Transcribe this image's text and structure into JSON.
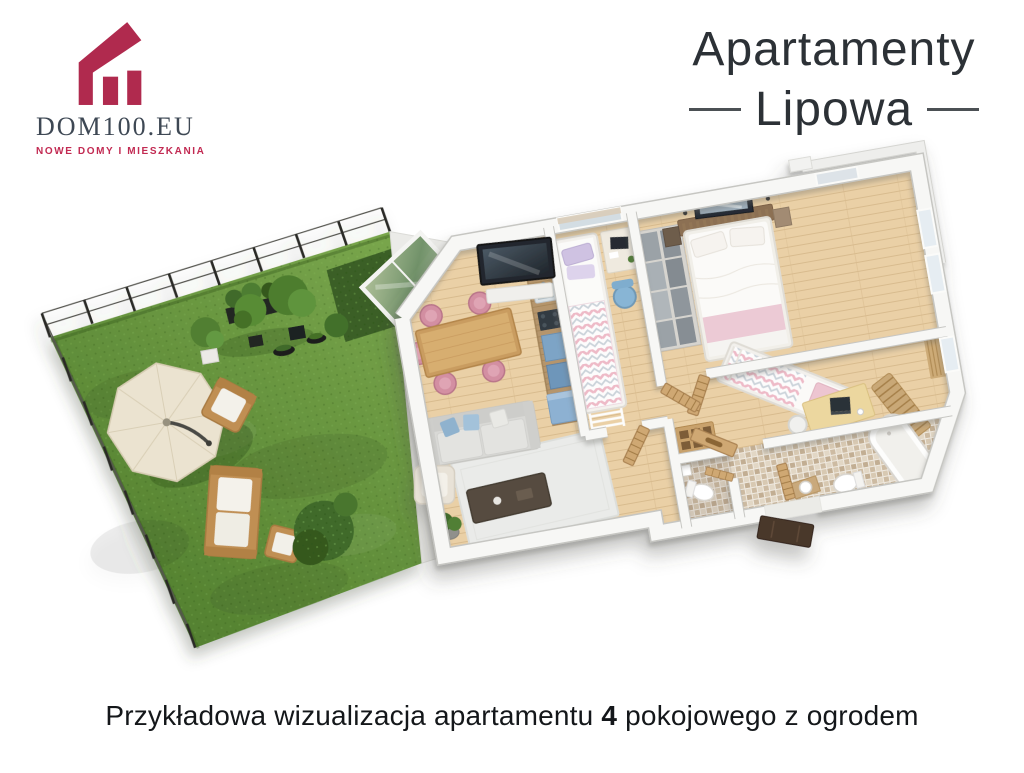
{
  "branding": {
    "name": "DOM100.EU",
    "tagline": "NOWE DOMY I MIESZKANIA"
  },
  "header": {
    "title_line1": "Apartamenty",
    "title_line2": "Lipowa"
  },
  "caption": {
    "prefix": "Przykładowa wizualizacja apartamentu ",
    "highlight": "4",
    "suffix": " pokojowego z ogrodem"
  },
  "palette": {
    "brand_crimson": "#b02a4e",
    "logo_text": "#3e4854",
    "title_text": "#2c3136",
    "caption_text": "#14171a",
    "grass_green": "#5e8c36",
    "wood_floor": "#ead0a6",
    "wall_white": "#f7f7f5",
    "kitchen_blue": "#7da4c6",
    "chair_pink": "#d38fa2",
    "door_tan": "#cfa873",
    "entrance_brown": "#4a3729",
    "tile_beige": "#cdbba2"
  },
  "illustration": {
    "type": "3d-floorplan-render",
    "areas": [
      "garden",
      "terrace",
      "living-dining-room",
      "kitchen",
      "bedroom-1",
      "master-bedroom",
      "bedroom-2",
      "bathroom",
      "wc",
      "hall"
    ]
  }
}
